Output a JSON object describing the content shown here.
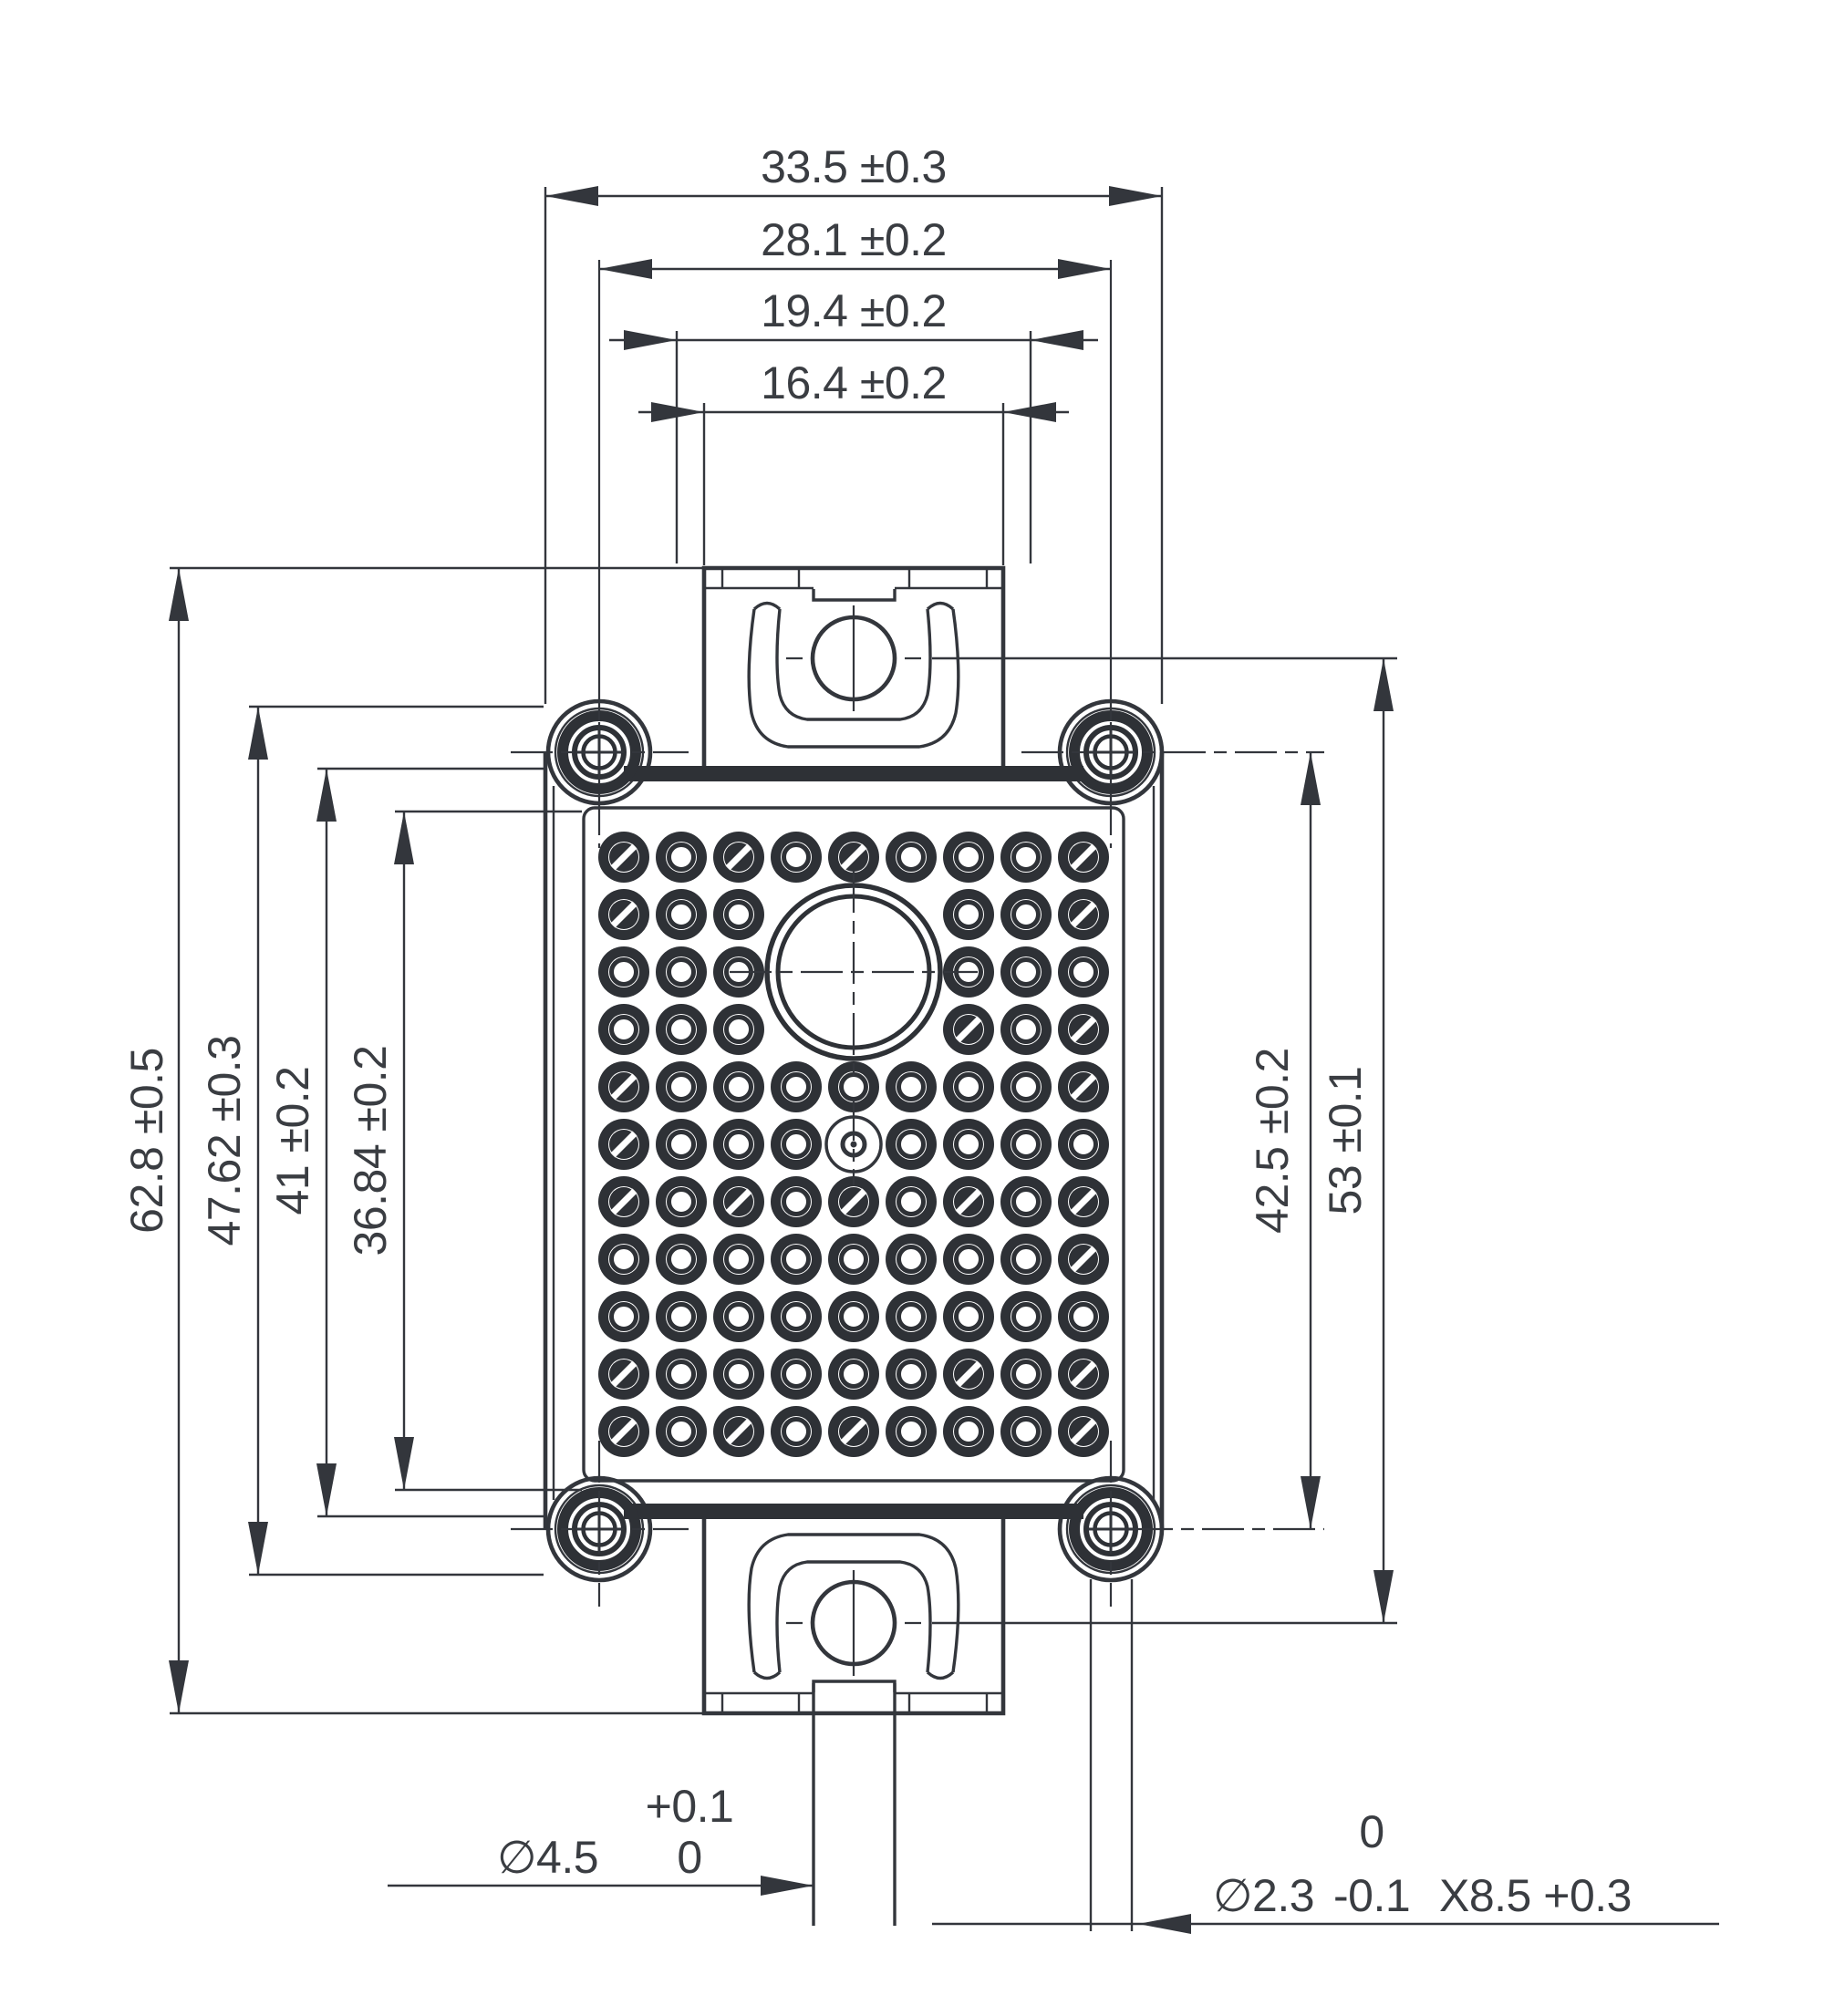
{
  "drawing": {
    "kind": "mechanical outline drawing of a power semiconductor module, top view",
    "colors": {
      "line": "#33363c",
      "dark_fill": "#2e3136",
      "text": "#3a3d42",
      "background": "#ffffff"
    }
  },
  "dims": {
    "top": [
      {
        "label": "33.5 ±0.3"
      },
      {
        "label": "28.1 ±0.2"
      },
      {
        "label": "19.4 ±0.2"
      },
      {
        "label": "16.4 ±0.2"
      }
    ],
    "left": [
      {
        "label": "62.8 ±0.5"
      },
      {
        "label": "47.62 ±0.3"
      },
      {
        "label": "41 ±0.2"
      },
      {
        "label": "36.84 ±0.2"
      }
    ],
    "right": [
      {
        "label": "42.5 ±0.2"
      },
      {
        "label": "53 ±0.1"
      }
    ],
    "bottom_left": {
      "value": "∅4.5",
      "tol_upper": "+0.1",
      "tol_lower": "0"
    },
    "bottom_right": {
      "value": "∅2.3",
      "tol_upper": "0",
      "tol_lower": "-0.1",
      "suffix": "X8.5 +0.3"
    }
  },
  "module": {
    "pin_grid": {
      "rows": 11,
      "cols": 9,
      "missing": [
        [
          2,
          4
        ],
        [
          2,
          5
        ],
        [
          2,
          6
        ],
        [
          3,
          4
        ],
        [
          3,
          5
        ],
        [
          3,
          6
        ],
        [
          4,
          4
        ],
        [
          4,
          5
        ],
        [
          4,
          6
        ]
      ],
      "special": [
        6,
        5
      ],
      "slashed": [
        [
          1,
          1
        ],
        [
          1,
          3
        ],
        [
          1,
          5
        ],
        [
          1,
          9
        ],
        [
          2,
          1
        ],
        [
          2,
          9
        ],
        [
          4,
          7
        ],
        [
          4,
          9
        ],
        [
          5,
          1
        ],
        [
          5,
          9
        ],
        [
          6,
          1
        ],
        [
          7,
          1
        ],
        [
          7,
          3
        ],
        [
          7,
          5
        ],
        [
          7,
          7
        ],
        [
          7,
          9
        ],
        [
          8,
          9
        ],
        [
          10,
          1
        ],
        [
          10,
          7
        ],
        [
          10,
          9
        ],
        [
          11,
          1
        ],
        [
          11,
          3
        ],
        [
          11,
          5
        ],
        [
          11,
          9
        ]
      ]
    },
    "features": {
      "mounting_screws": 4,
      "large_center_hole": 1,
      "small_center_hole": 1,
      "top_mounting_tab": 1,
      "bottom_mounting_tab": 1,
      "bottom_terminal_stem": 1
    }
  }
}
